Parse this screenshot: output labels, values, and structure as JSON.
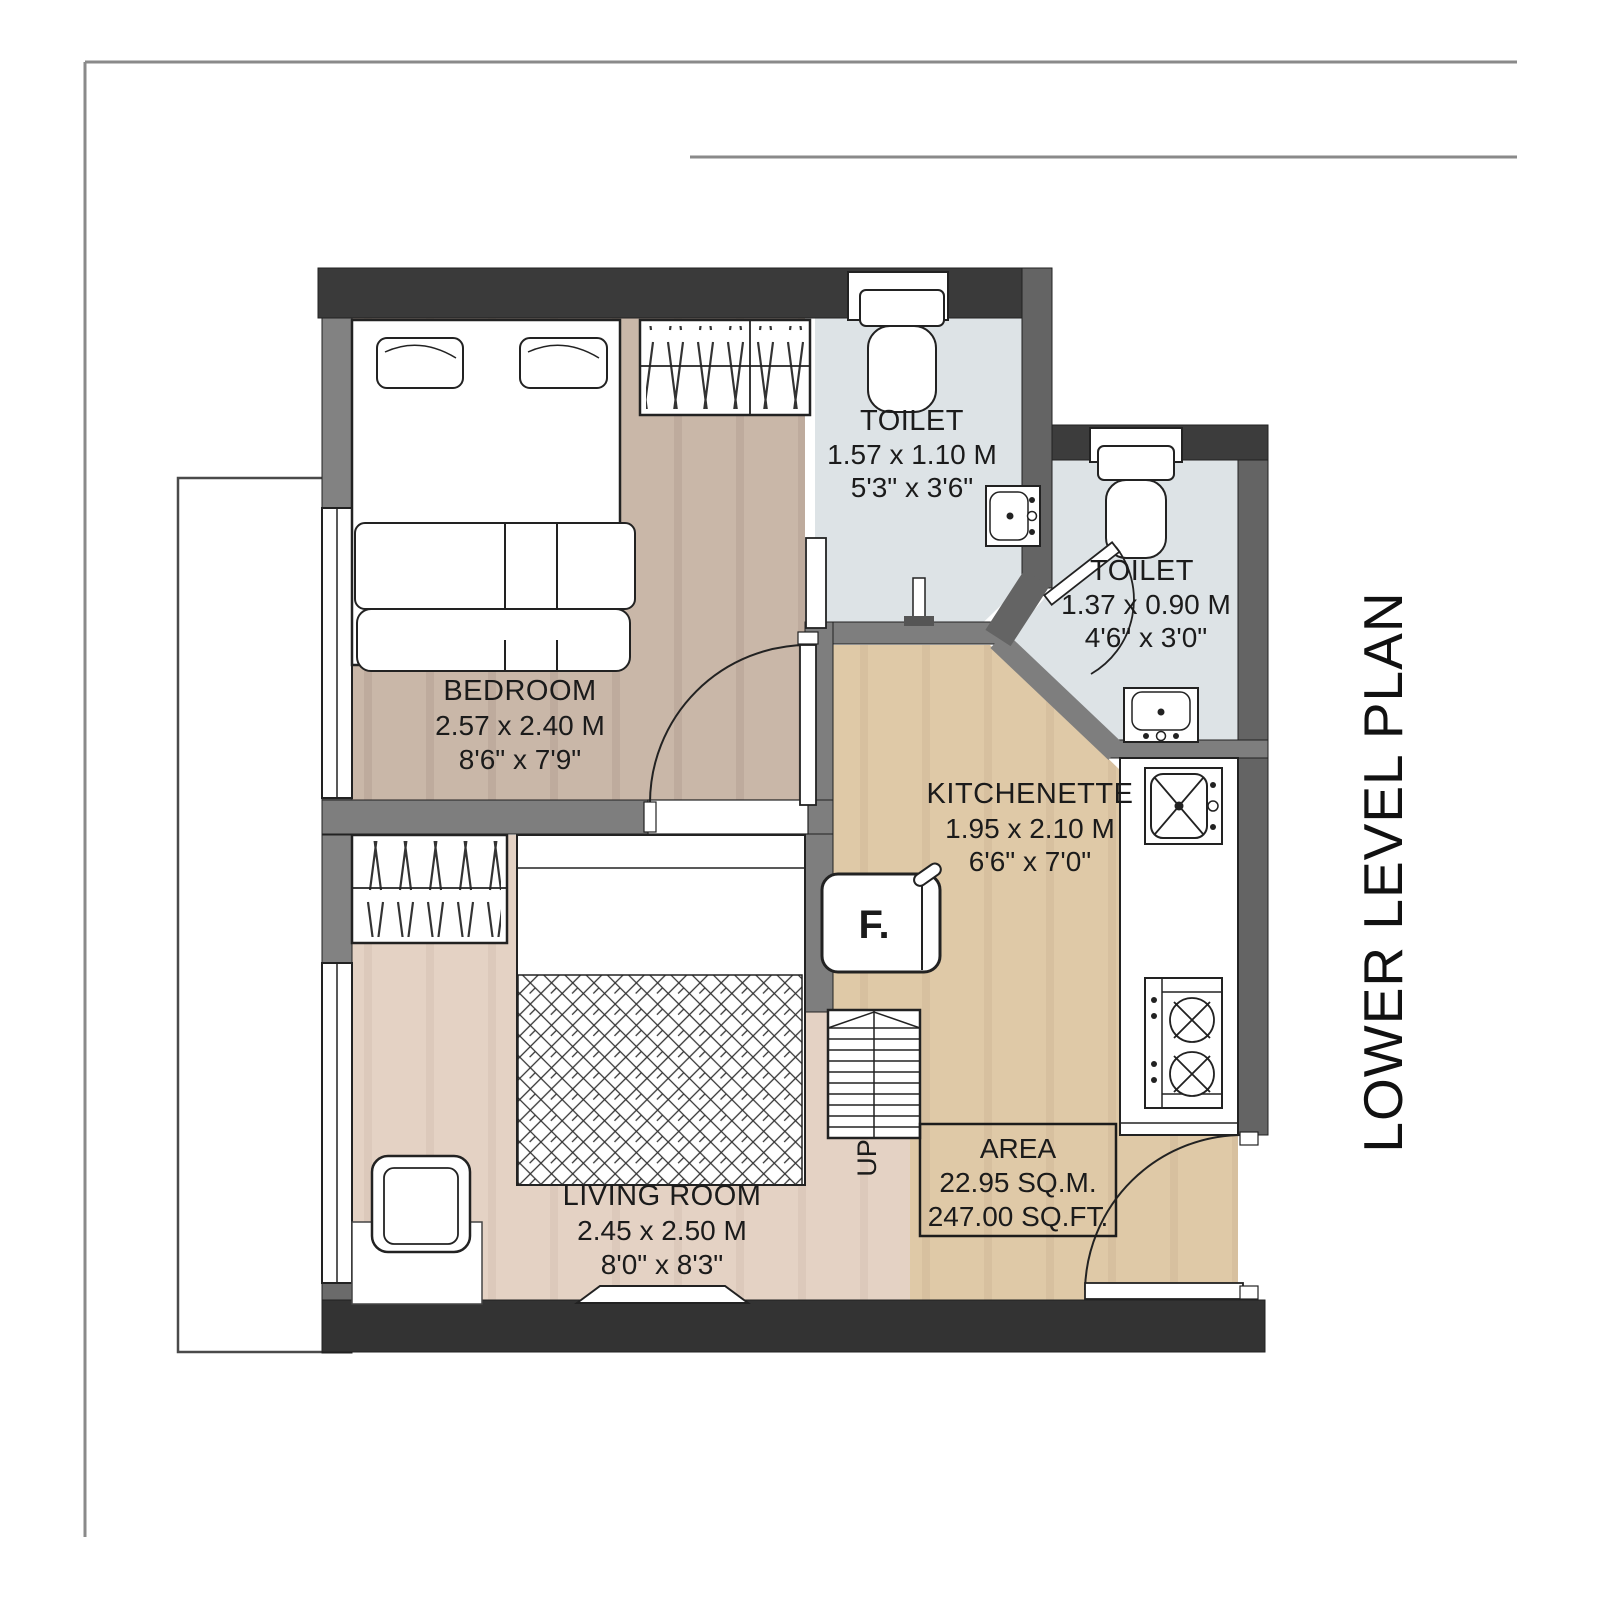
{
  "title": {
    "plan_label": "LOWER LEVEL PLAN"
  },
  "rooms": [
    {
      "id": "bedroom",
      "name": "BEDROOM",
      "dim_m": "2.57 x 2.40 M",
      "dim_ft": "8'6\" x 7'9\""
    },
    {
      "id": "toilet-1",
      "name": "TOILET",
      "dim_m": "1.57 x 1.10 M",
      "dim_ft": "5'3\" x 3'6\""
    },
    {
      "id": "toilet-2",
      "name": "TOILET",
      "dim_m": "1.37 x 0.90 M",
      "dim_ft": "4'6\" x 3'0\""
    },
    {
      "id": "kitchenette",
      "name": "KITCHENETTE",
      "dim_m": "1.95 x 2.10 M",
      "dim_ft": "6'6\" x 7'0\""
    },
    {
      "id": "living-room",
      "name": "LIVING ROOM",
      "dim_m": "2.45 x 2.50 M",
      "dim_ft": "8'0\" x 8'3\""
    }
  ],
  "area_box": {
    "label": "AREA",
    "sqm": "22.95 SQ.M.",
    "sqft": "247.00 SQ.FT."
  },
  "annotations": {
    "fridge": "F.",
    "stairs_direction": "UP"
  },
  "colors": {
    "wall_dark": "#3a3a3a",
    "wall_mid": "#666666",
    "wall_light": "#7f7f7f",
    "floor_bedroom": "#c9b7a8",
    "floor_living": "#e4d2c4",
    "floor_kitchen": "#dfc9a7",
    "floor_toilet": "#dde3e6",
    "line": "#1f1f1f"
  }
}
